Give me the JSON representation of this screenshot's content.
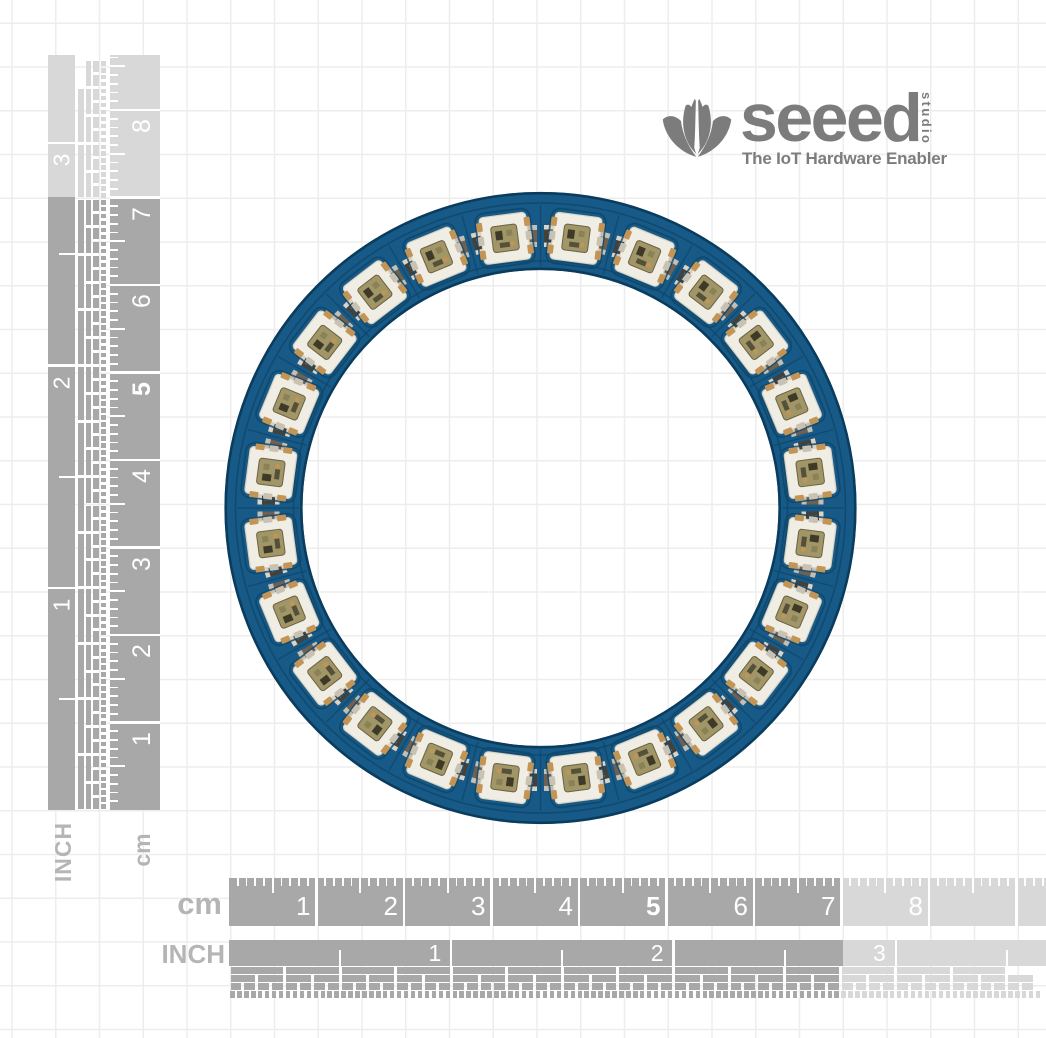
{
  "background": {
    "color": "#ffffff",
    "grid_color": "#ededed"
  },
  "logo": {
    "icon": "seeed-lotus-icon",
    "brand": "seeed",
    "studio": "studio",
    "tagline": "The IoT Hardware Enabler",
    "color": "#7c7c7c"
  },
  "rulers": {
    "colors": {
      "dark": "#a8a8a8",
      "light": "#d8d8d8",
      "tick": "#ffffff",
      "side_label": "#b5b5b5"
    },
    "bold_number": "5",
    "left_inch": {
      "label": "INCH",
      "numbers": [
        "1",
        "2",
        "3"
      ]
    },
    "left_cm": {
      "label": "cm",
      "numbers": [
        "1",
        "2",
        "3",
        "4",
        "5",
        "6",
        "7",
        "8"
      ]
    },
    "bottom_cm": {
      "label": "cm",
      "numbers": [
        "1",
        "2",
        "3",
        "4",
        "5",
        "6",
        "7",
        "8"
      ]
    },
    "bottom_inch": {
      "label": "INCH",
      "numbers": [
        "1",
        "2",
        "3"
      ]
    }
  },
  "board": {
    "type": "rgb-led-ring-pcb",
    "led_count": 24,
    "passive_pairs": 24,
    "resistor_marking": "101",
    "colors": {
      "pcb": "#175a87",
      "pcb_trace": "#0f4568",
      "pcb_edge": "#0a3c5e",
      "led_body": "#f0ede5",
      "led_border": "#d6d2c4",
      "pad_gold": "#c29455",
      "pad_silver": "#c9c2b2",
      "led_center": "#a09667",
      "led_center_border": "#6d6140",
      "chip_dark": "#3f3a28",
      "chip_mid": "#55503a",
      "chip_light": "#8b8157",
      "cap_body": "#6e6152",
      "cap_end": "#c2bfb6",
      "res_body": "#454139",
      "res_end": "#d8d4ca",
      "via": "#ffffff"
    }
  }
}
